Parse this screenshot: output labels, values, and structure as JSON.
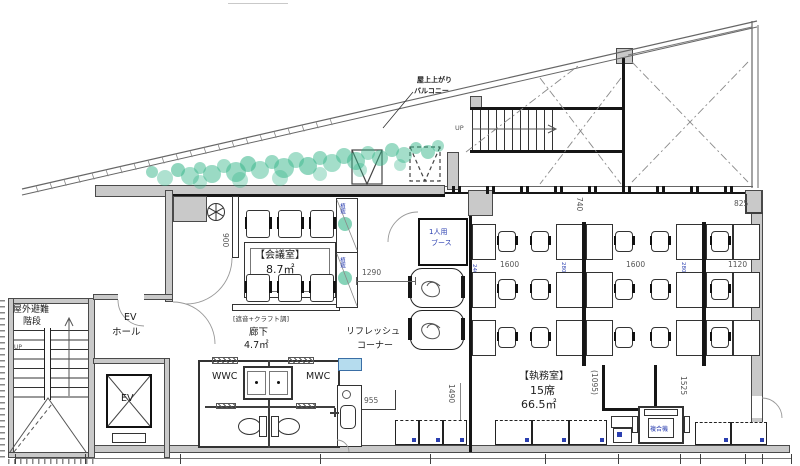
{
  "balcony": {
    "note1": "屋上上がり",
    "note2": "バルコニー",
    "up": "UP",
    "planter_label": "植栽"
  },
  "stairwell": {
    "line1": "屋外避難",
    "line2": "階段",
    "up": "UP"
  },
  "elevator": {
    "hall1": "EV",
    "hall2": "ホール",
    "car": "EV"
  },
  "meeting_room": {
    "title": "【会議室】",
    "area": "8.7㎡",
    "note": "[遮音+クラフト調]"
  },
  "corridor": {
    "title": "廊下",
    "area": "4.7㎡"
  },
  "toilets": {
    "women": "WWC",
    "men": "MWC"
  },
  "refresh": {
    "line1": "リフレッシュ",
    "line2": "コーナー"
  },
  "booth": {
    "line1": "1人用",
    "line2": "ブース"
  },
  "office": {
    "title": "【執務室】",
    "seats": "15席",
    "area": "66.5㎡",
    "copier": "複合機"
  },
  "dims": {
    "w1290": "1290",
    "w955": "955",
    "h1490": "1490",
    "w1600": "1600",
    "w825": "825",
    "w1120": "1120",
    "h1095": "(1095)",
    "h1525": "1525",
    "h900": "900",
    "h740": "740"
  },
  "desk_notes": {
    "island": "2800×1400",
    "wall": "2400×700"
  },
  "colors": {
    "line": "#4a4a4a",
    "wall_fill": "#c9c9c9",
    "accent_blue": "#2b3fb0",
    "green": "#35b589",
    "highlight": "#b5dcee"
  }
}
